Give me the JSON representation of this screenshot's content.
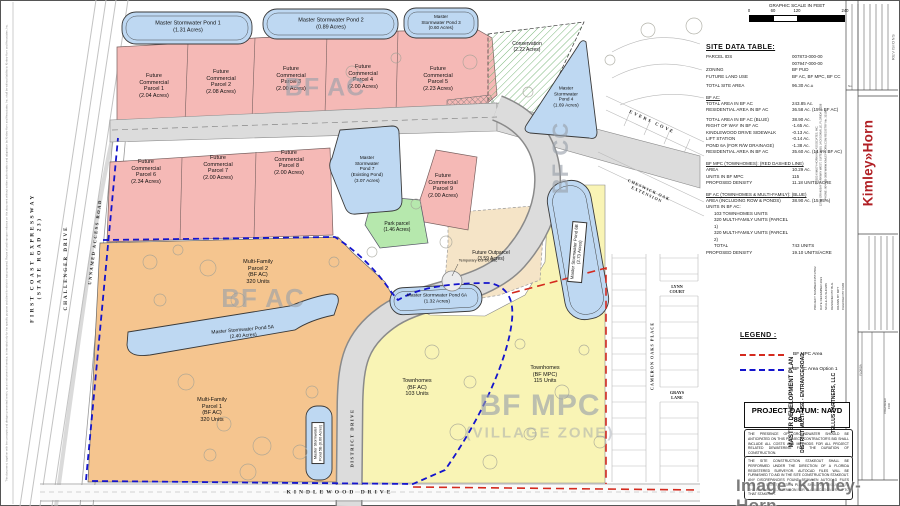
{
  "colors": {
    "commercial": "#f5b9b6",
    "pond": "#bed8f2",
    "multifamily": "#f5c58f",
    "townhomes": "#f9f4b5",
    "park": "#b6e8ad",
    "outparcel": "#f5e4c7",
    "conservation": "#7cb87c",
    "mpc": "#d42a1e",
    "ac": "#1414cc",
    "road": "#dcdcdc",
    "logo": "#b01f24"
  },
  "labels": {
    "pond1": "Master Stormwater Pond 1\n(1.31 Acres)",
    "pond2": "Master Stormwater Pond 2\n(0.89 Acres)",
    "pond3": "Master\nStormwater Pond 3\n(0.60 Acres)",
    "pond4": "Master\nStormwater\nPond 4\n(1.69 Acres)",
    "pond7": "Master\nStormwater\nPond 7\n(Existing Pond)\n(3.07 Acres)",
    "pond5a": "Master Stormwater Pond 5A\n(2.40 Acres)",
    "pond5b": "Master Stormwater\nPond 5B (0.60 Acres)",
    "pond6a": "Master Stormwater Pond 6A\n(1.32 Acres)",
    "pond6b": "Master Stormwater Pond 6B\n(2.73 Acres)",
    "fc1": "Future\nCommercial\nParcel 1\n(2.04 Acres)",
    "fc2": "Future\nCommercial\nParcel 2\n(2.08 Acres)",
    "fc3": "Future\nCommercial\nParcel 3\n(2.00 Acres)",
    "fc4": "Future\nCommercial\nParcel 4\n(2.00 Acres)",
    "fc5": "Future\nCommercial\nParcel 5\n(2.23 Acres)",
    "fc6": "Future\nCommercial\nParcel 6\n(2.34 Acres)",
    "fc7": "Future\nCommercial\nParcel 7\n(2.00 Acres)",
    "fc8": "Future\nCommercial\nParcel 8\n(2.00 Acres)",
    "fc9": "Future\nCommercial\nParcel 9\n(2.00 Acres)",
    "conservation": "Conservation\n(2.22 Acres)",
    "park": "Park parcel\n(1.46 Acres)",
    "outparcel": "Future Outparcel\n(3.59 Acres)",
    "culdesac": "Temporary Cul-De-Sac",
    "mf2": "Multi-Family\nParcel 2\n(BF AC)\n320 Units",
    "mf1": "Multi-Family\nParcel 1\n(BF AC)\n320 Units",
    "th_ac": "Townhomes\n(BF AC)\n103 Units",
    "th_mpc": "Townhomes\n(BF MPC)\n115 Units"
  },
  "zones": {
    "bf_ac_top": "BF AC",
    "bf_ac_mid": "BF AC",
    "bf_mpc": "BF MPC",
    "village": "(VILLAGE ZONE)",
    "bf_cc": "BF CC"
  },
  "roads": {
    "first_coast": "FIRST COAST EXPRESSWAY\n(STATE ROAD 23)",
    "challenger": "CHALLENGER DRIVE",
    "unnamed": "UNNAMED ACCESS ROAD",
    "kindlewood": "KINDLEWOOD DRIVE",
    "district": "DISTRICT DRIVE",
    "evers": "EVERS COVE",
    "cheswick": "CHESWICK OAK\nEXTENSION",
    "lynn": "LYNN\nCOURT",
    "cameron": "CAMERON OAKS PLACE",
    "grays": "GRAYS\nLANE"
  },
  "scalebar": {
    "title": "GRAPHIC SCALE IN FEET",
    "ticks": [
      "0",
      "60",
      "120",
      "240"
    ]
  },
  "site_data": {
    "title": "SITE DATA TABLE:",
    "rows": [
      {
        "l": "PARCEL IDS",
        "v": "007873-000-00\n007947-000-00"
      },
      {
        "l": "ZONING",
        "v": "BF PUD"
      },
      {
        "l": "FUTURE LAND USE",
        "v": "BF AC, BF MPC, BF CC"
      },
      {
        "l": "TOTAL SITE AREA",
        "v": "96.30 Ac.±"
      },
      {
        "l": "BF AC:",
        "v": ""
      },
      {
        "l": "TOTAL AREA IN BF AC",
        "v": "243.85 Ac."
      },
      {
        "l": "RESIDENTIAL AREA IN BF AC",
        "v": "36.58 Ac. (15% BF AC)"
      },
      {
        "l": "TOTAL AREA IN BF AC (BLUE)",
        "v": "38.90 Ac."
      },
      {
        "l": "RIGHT OF WAY IN BF AC",
        "v": "-1.65 Ac."
      },
      {
        "l": "KINDLEWOOD DRIVE SIDEWALK",
        "v": "-0.13 Ac."
      },
      {
        "l": "LIFT STATION",
        "v": "-0.14 Ac."
      },
      {
        "l": "POND 6A (FOR R/W DRAINAGE)",
        "v": "-1.38 Ac."
      },
      {
        "l": "RESIDENTIAL AREA IN BF AC",
        "v": "35.60 Ac. (14.6% BF AC)"
      },
      {
        "l": "BF MPC (TOWNHOMES): (RED DASHED LINE)",
        "v": ""
      },
      {
        "l": "AREA",
        "v": "10.29 Ac."
      },
      {
        "l": "UNITS IN BF MPC",
        "v": "115"
      },
      {
        "l": "PROPOSED DENSITY",
        "v": "11.18 UNITS/ACRE"
      },
      {
        "l": "BF AC (TOWNHOMES & MULTI-FAMILY): (BLUE)",
        "v": ""
      },
      {
        "l": "AREA (INCLUDING ROW & PONDS)",
        "v": "38.90 Ac. (15.95%)"
      },
      {
        "l": "UNITS IN BF AC:",
        "v": ""
      },
      {
        "l": "103 TOWNHOMES UNITS",
        "v": ""
      },
      {
        "l": "320 MULTI-FAMILY UNITS (PARCEL 1)",
        "v": ""
      },
      {
        "l": "320 MULTI-FAMILY UNITS (PARCEL 2)",
        "v": ""
      },
      {
        "l": "TOTAL",
        "v": "743 UNITS"
      },
      {
        "l": "PROPOSED DENSITY",
        "v": "19.10 UNITS/ACRE"
      }
    ]
  },
  "legend": {
    "title": "LEGEND :",
    "items": [
      {
        "label": "BF MPC Area"
      },
      {
        "label": "BF AC Area Option 1"
      }
    ]
  },
  "datum": "PROJECT DATUM: NAVD '88",
  "notes": {
    "note1": "THE PRESENCE OF GROUNDWATER SHOULD BE ANTICIPATED ON THIS PROJECT. CONTRACTOR'S BID SHALL INCLUDE ALL COSTS AND METHODS FOR ALL PROJECT RELATED DEWATERING FOR THE DURATION OF CONSTRUCTION.",
    "note2": "THE SITE CONSTRUCTION STAKEOUT SHALL BE PERFORMED UNDER THE DIRECTION OF A FLORIDA REGISTERED SURVEYOR. AUTOCAD FILES WILL BE FURNISHED TO AID IN THE SITE CONSTRUCTION STAKEOUT. ANY DISCREPANCIES FOUND BETWEEN AUTOCAD FILES AND SITE CONSTRUCTION PLANS SHALL BE BROUGHT TO THE ENGINEER'S ATTENTION FOR CLARIFICATION PRIOR TO THAT STAKEOUT."
  },
  "titleblock": {
    "revisions": "REVISIONS",
    "no": "No.",
    "logo": "Kimley»Horn",
    "logo_sub": "© 2023 KIMLEY-HORN AND ASSOCIATES, INC.\n12740 GRAN BAY PARKWAY WEST, SUITE 2350, JACKSONVILLE, FLORIDA 32258\nPHONE: 904-828-3900   WWW.KIMLEY-HORN.COM   REGISTRY No. 35106",
    "meta": "PROJECT NUMBER  045717002\nDATE  DECEMBER 2023\nSCALE  AS SHOWN\nDESIGNED BY  BLG\nDRAWN BY  MPT\nCHECKED BY  CMR",
    "sheet_title": "MASTER DEVELOPMENT PLAN",
    "project": "DISTRICT MULTI-USE - ENTRANCE ROAD",
    "prepared_for": "PREPARED FOR",
    "client": "TELLUS PARTNERS, LLC",
    "state": "FLORIDA"
  },
  "watermark": "Image: Kimley-Horn",
  "disclaimer": "This document, together with the concepts and designs presented herein, as an instrument of service, is intended only for the specific purpose and client for which it was prepared. Reuse of and improper reliance on this document without written authorization and adaptation by Kimley-Horn and Associates, Inc. shall be without liability to Kimley-Horn and Associates, Inc."
}
